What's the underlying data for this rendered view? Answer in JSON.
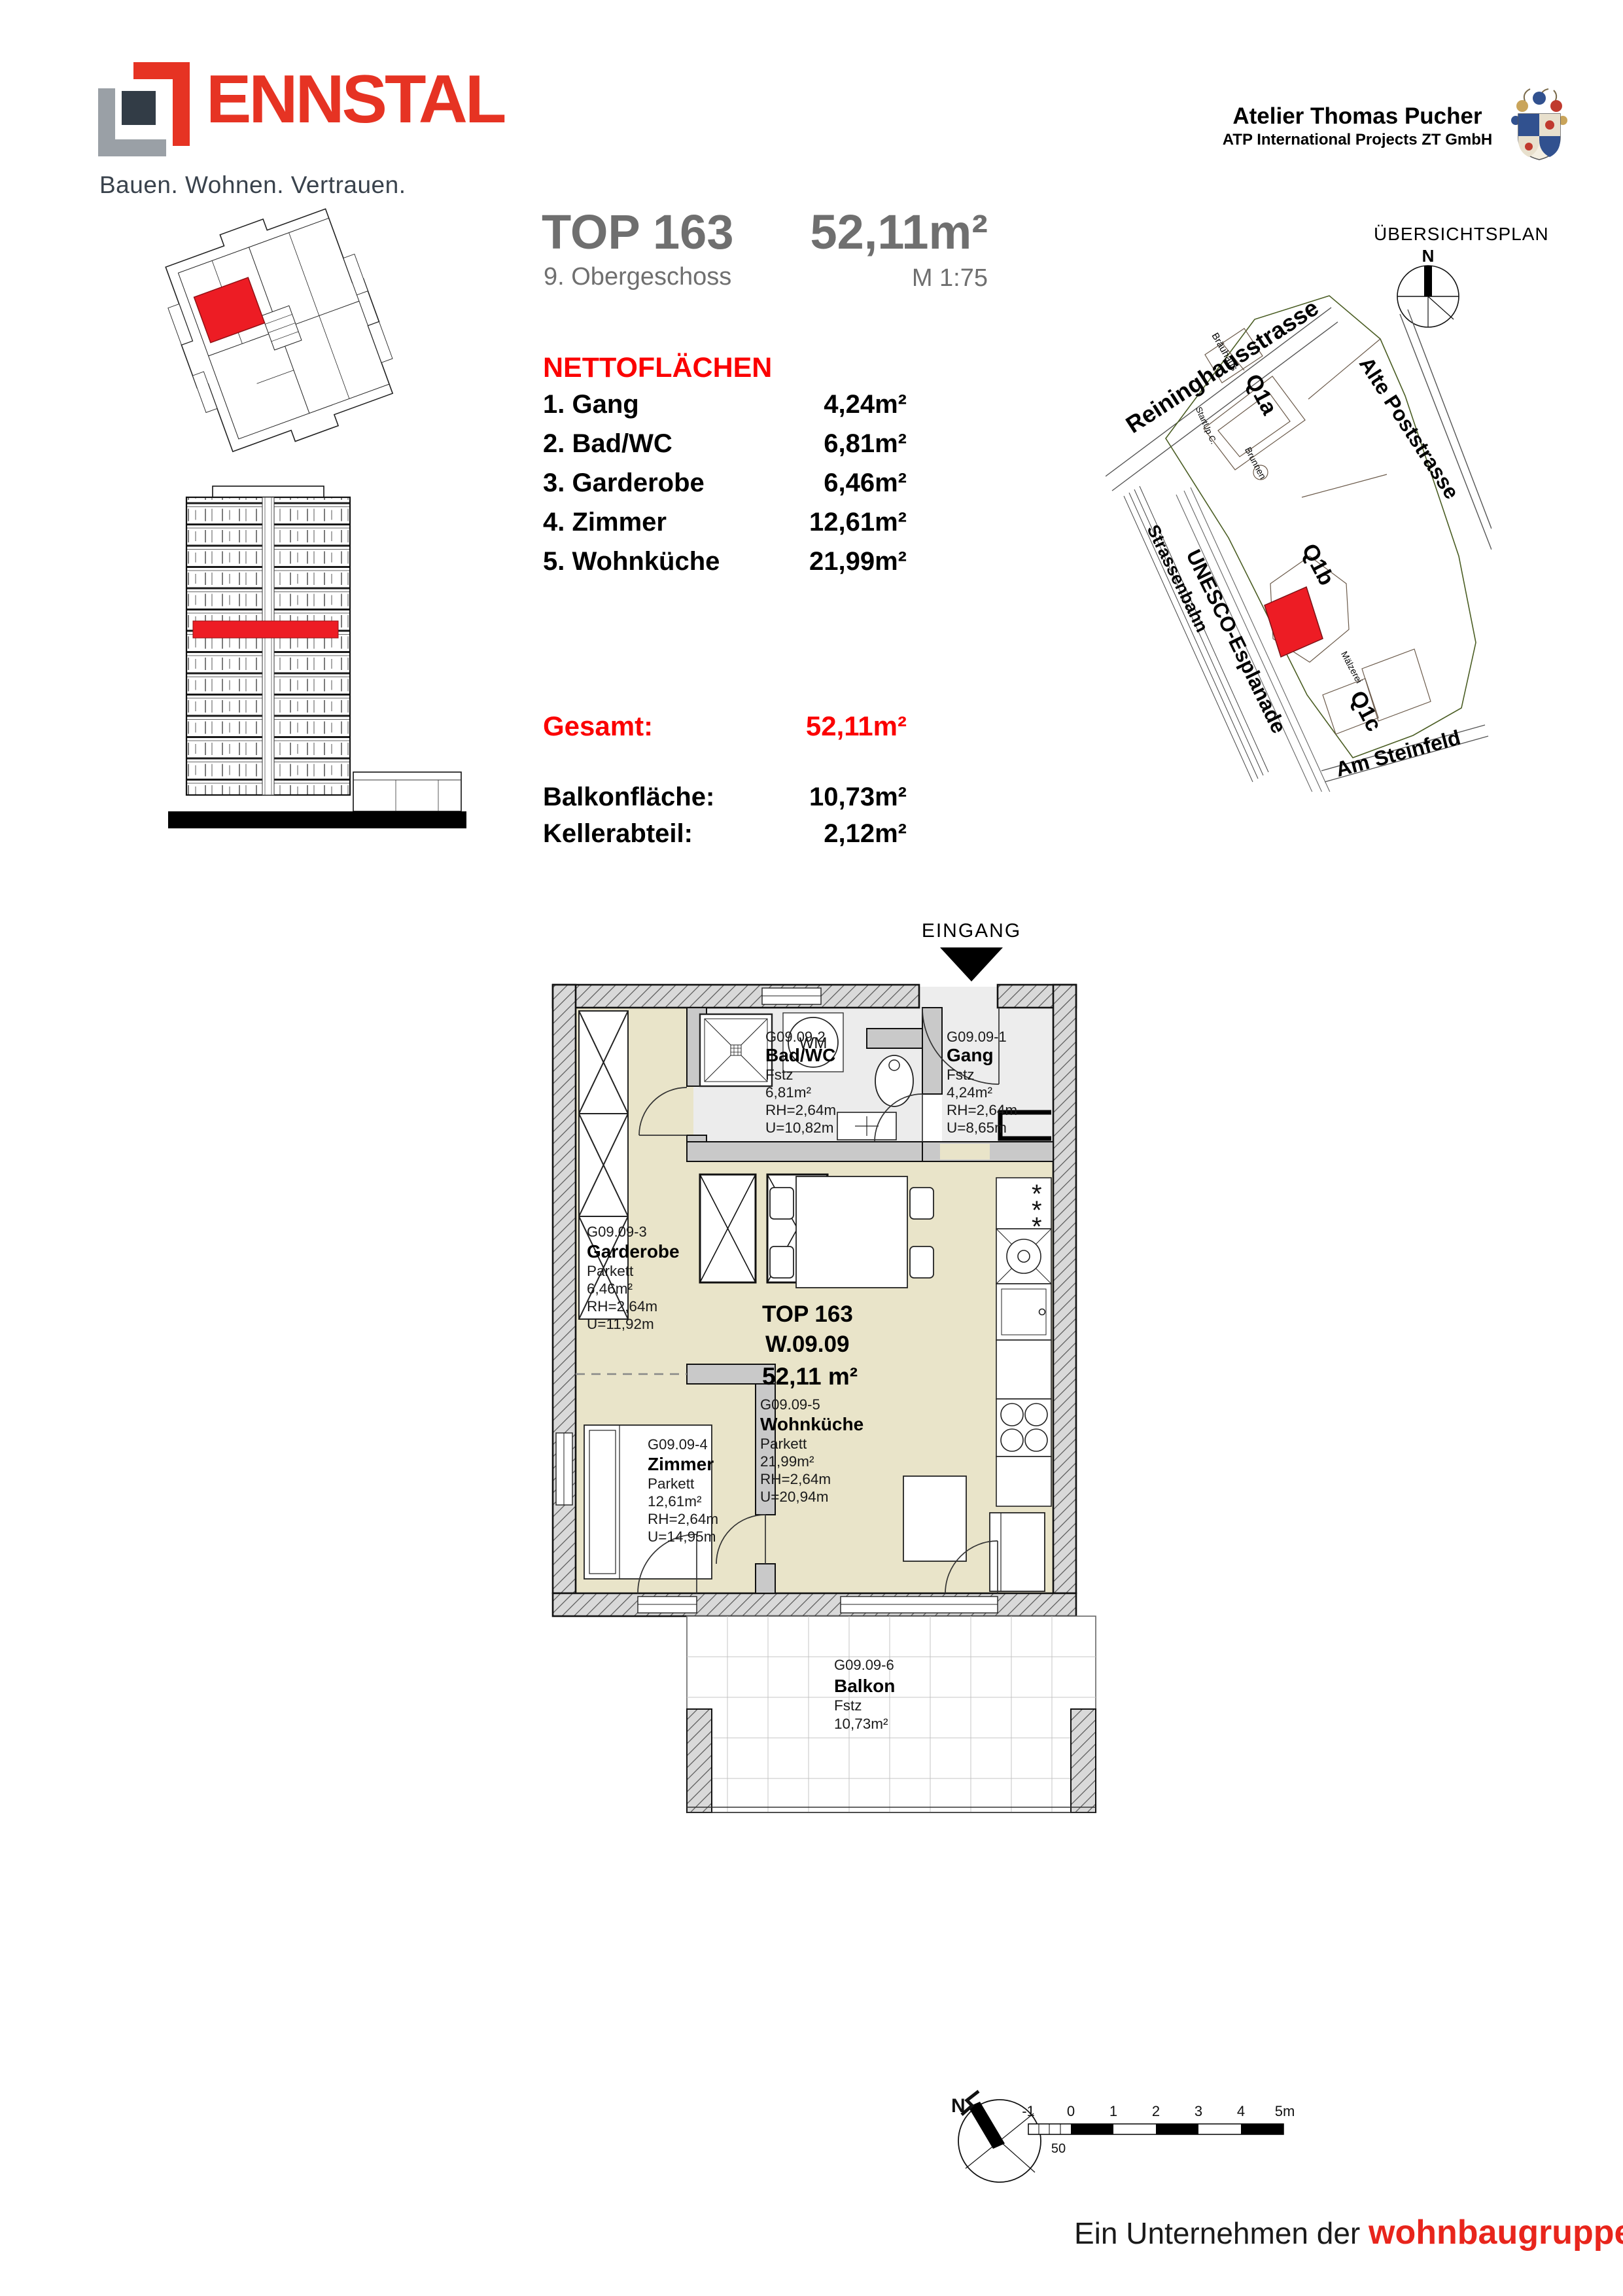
{
  "colors": {
    "brand_red": "#e63323",
    "pure_red": "#fb0000",
    "map_red": "#ed1c24",
    "footer_red": "#e8251c",
    "text_gray": "#6f6f6f",
    "tagline_gray": "#39424c",
    "parquet": "#e9e4c9",
    "tile": "#ececec",
    "wall": "#c9c9c9"
  },
  "header": {
    "brand": "ENNSTAL",
    "tagline": "Bauen. Wohnen. Vertrauen.",
    "architect": "Atelier Thomas Pucher",
    "architect_sub": "ATP International Projects ZT GmbH"
  },
  "title": {
    "top": "TOP 163",
    "area": "52,11m²",
    "floor": "9. Obergeschoss",
    "scale": "M 1:75"
  },
  "netto": {
    "heading": "NETTOFLÄCHEN",
    "rows": [
      {
        "label": "1. Gang",
        "value": "4,24m²"
      },
      {
        "label": "2. Bad/WC",
        "value": "6,81m²"
      },
      {
        "label": "3. Garderobe",
        "value": "6,46m²"
      },
      {
        "label": "4. Zimmer",
        "value": "12,61m²"
      },
      {
        "label": "5. Wohnküche",
        "value": "21,99m²"
      }
    ]
  },
  "totals": {
    "gesamt_label": "Gesamt:",
    "gesamt_value": "52,11m²",
    "balkon_label": "Balkonfläche:",
    "balkon_value": "10,73m²",
    "keller_label": "Kellerabteil:",
    "keller_value": "2,12m²"
  },
  "site": {
    "title": "ÜBERSICHTSPLAN",
    "north": "N",
    "streets": {
      "reininghaus": "Reininghausstrasse",
      "strassenbahn": "Strassenbahn",
      "unesco": "UNESCO-Esplanade",
      "poststrasse": "Alte Poststrasse",
      "steinfeld": "Am Steinfeld"
    },
    "quarters": {
      "q1a": "Q1a",
      "q1b": "Q1b",
      "q1c": "Q1c"
    },
    "pois": {
      "brauhaus": "Bräuhaus",
      "brunnen": "Brunnen",
      "maelzerei": "Mälzerei",
      "startup": "StartUp C."
    }
  },
  "plan": {
    "eingang": "EINGANG",
    "wm": "WM",
    "star": "*",
    "unit": {
      "top": "TOP 163",
      "nr": "W.09.09",
      "area": "52,11 m²"
    },
    "rooms": [
      {
        "code": "G09.09-1",
        "name": "Gang",
        "floor": "Fstz",
        "area": "4,24m²",
        "rh": "RH=2,64m",
        "u": "U=8,65m"
      },
      {
        "code": "G09.09-2",
        "name": "Bad/WC",
        "floor": "Fstz",
        "area": "6,81m²",
        "rh": "RH=2,64m",
        "u": "U=10,82m"
      },
      {
        "code": "G09.09-3",
        "name": "Garderobe",
        "floor": "Parkett",
        "area": "6,46m²",
        "rh": "RH=2,64m",
        "u": "U=11,92m"
      },
      {
        "code": "G09.09-4",
        "name": "Zimmer",
        "floor": "Parkett",
        "area": "12,61m²",
        "rh": "RH=2,64m",
        "u": "U=14,95m"
      },
      {
        "code": "G09.09-5",
        "name": "Wohnküche",
        "floor": "Parkett",
        "area": "21,99m²",
        "rh": "RH=2,64m",
        "u": "U=20,94m"
      },
      {
        "code": "G09.09-6",
        "name": "Balkon",
        "floor": "Fstz",
        "area": "10,73m²"
      }
    ]
  },
  "footer": {
    "company_prefix": "Ein Unternehmen der ",
    "company": "wohnbaugruppe.at",
    "north": "N",
    "fifty": "50",
    "scale_ticks": [
      "-1",
      "0",
      "1",
      "2",
      "3",
      "4",
      "5m"
    ]
  }
}
